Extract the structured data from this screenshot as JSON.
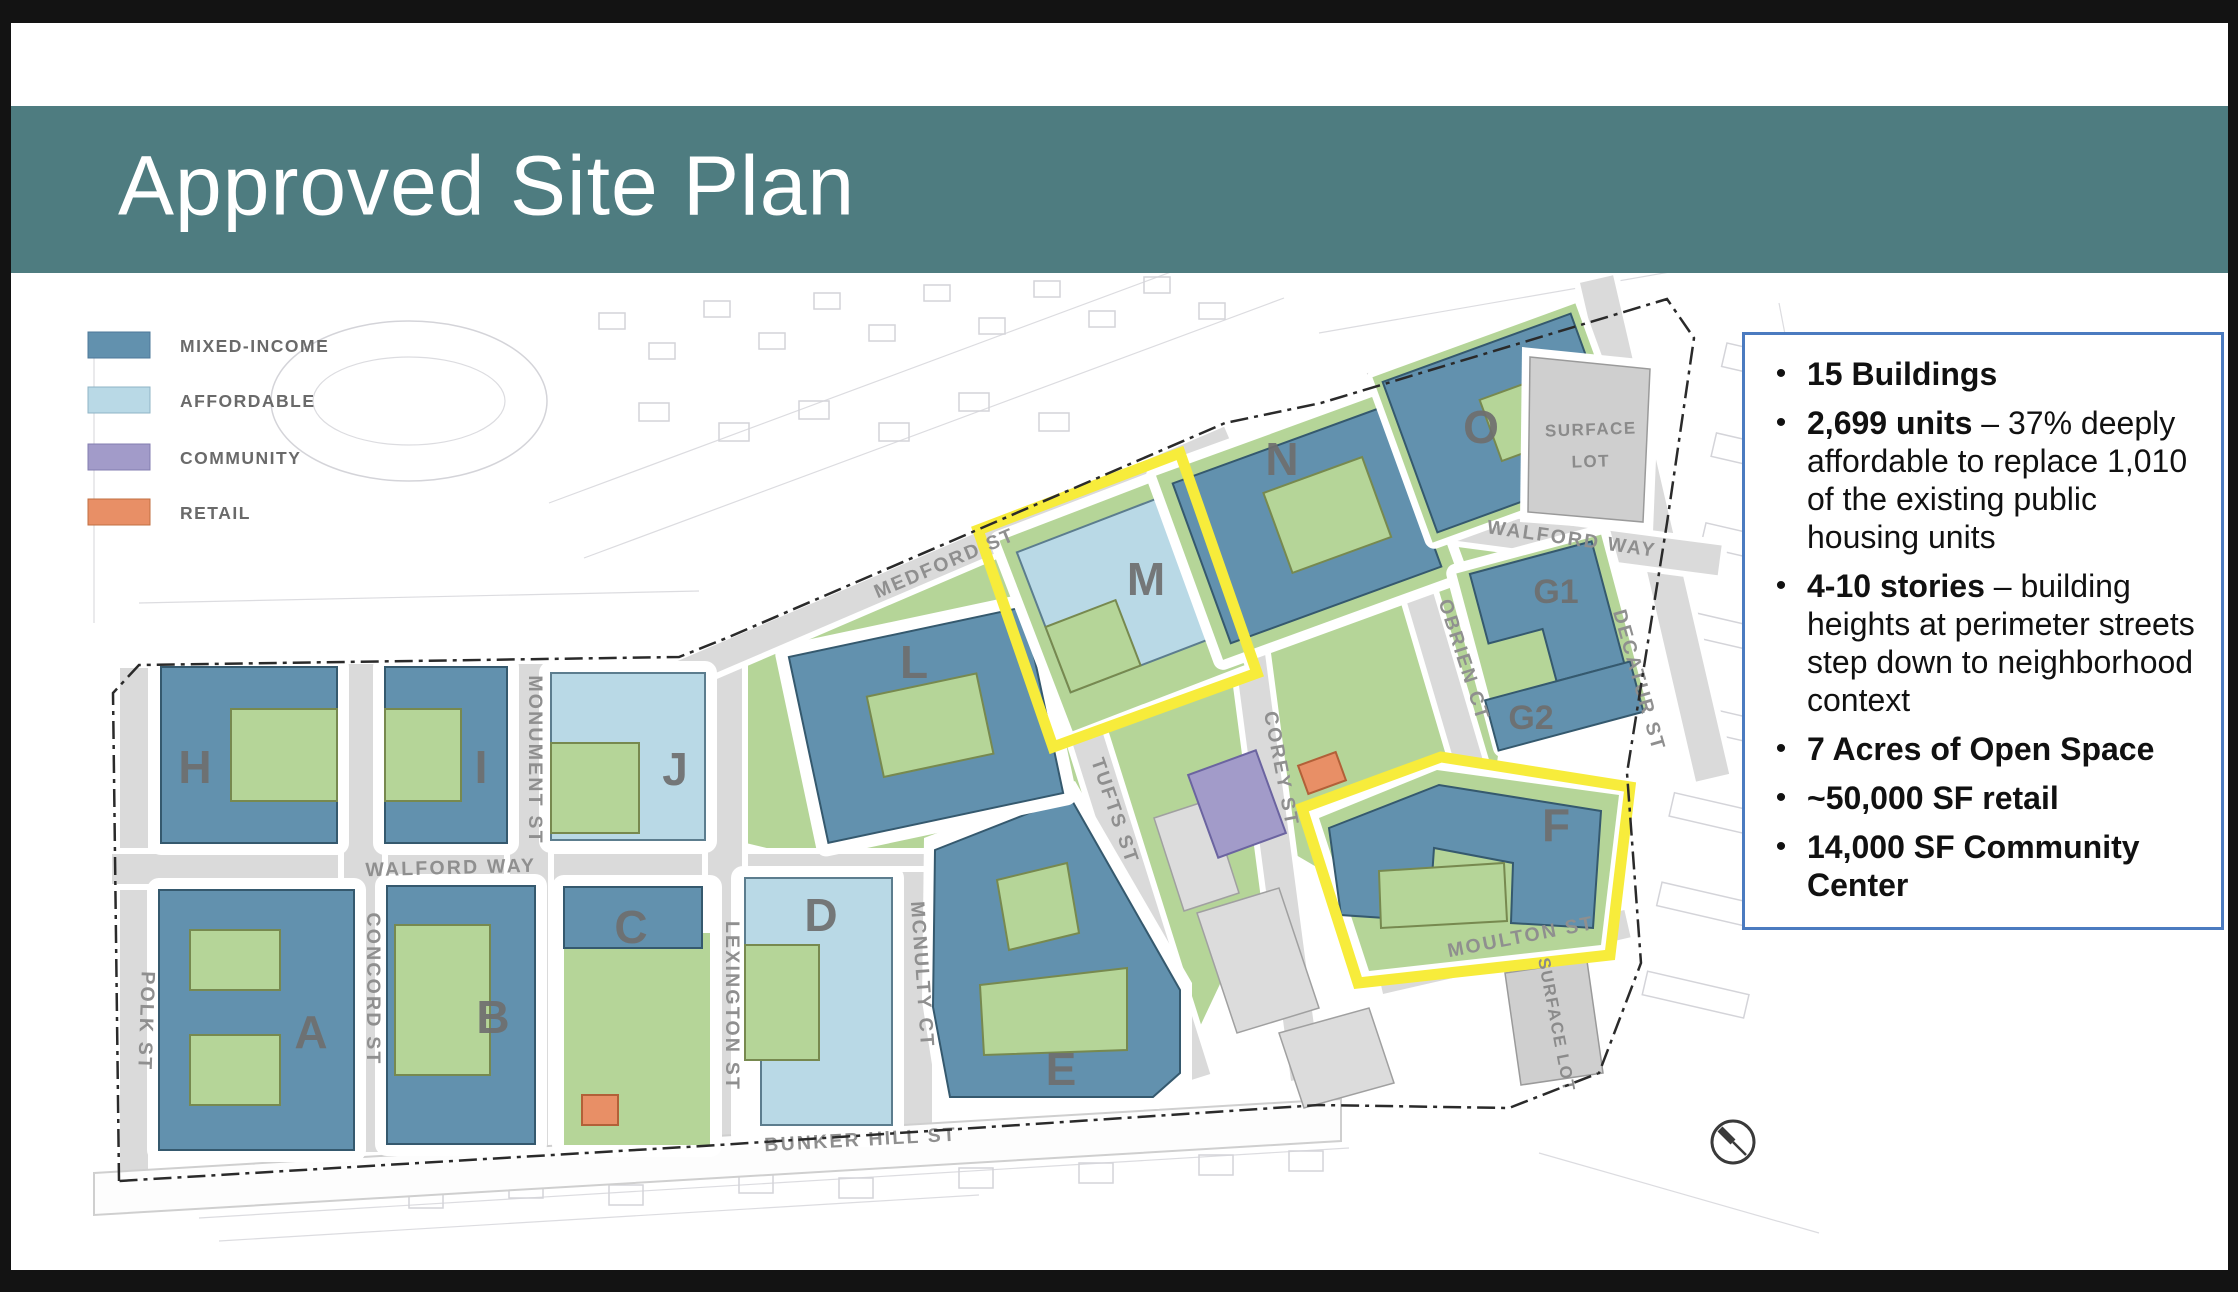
{
  "header": {
    "title": "Approved Site Plan"
  },
  "legend": {
    "items": [
      {
        "label": "MIXED-INCOME",
        "color": "#6291ae"
      },
      {
        "label": "AFFORDABLE",
        "color": "#b9d9e6"
      },
      {
        "label": "COMMUNITY",
        "color": "#a29bc9"
      },
      {
        "label": "RETAIL",
        "color": "#e88f66"
      }
    ]
  },
  "facts": {
    "items": [
      {
        "lead": "15 Buildings",
        "rest": ""
      },
      {
        "lead": "2,699 units",
        "rest": " – 37% deeply affordable to replace 1,010 of the existing public housing units"
      },
      {
        "lead": "4-10 stories",
        "rest": " – building heights at perimeter streets step down to neighborhood context"
      },
      {
        "lead": "7 Acres of Open Space",
        "rest": ""
      },
      {
        "lead": "~50,000 SF retail",
        "rest": ""
      },
      {
        "lead": "14,000 SF Community Center",
        "rest": ""
      }
    ]
  },
  "map": {
    "buildings": {
      "a": "A",
      "b": "B",
      "c": "C",
      "d": "D",
      "e": "E",
      "f": "F",
      "g1": "G1",
      "g2": "G2",
      "h": "H",
      "i": "I",
      "j": "J",
      "l": "L",
      "m": "M",
      "n": "N",
      "o": "O"
    },
    "streets": {
      "medford": "MEDFORD ST",
      "monument": "MONUMENT ST",
      "concord": "CONCORD ST",
      "polk": "POLK ST",
      "lexington": "LEXINGTON ST",
      "mcnulty": "MCNULTY CT",
      "walford_left": "WALFORD WAY",
      "walford_right": "WALFORD WAY",
      "tufts": "TUFTS ST",
      "corey": "COREY ST",
      "obrien": "OBRIEN CT",
      "decatur": "DECATUR ST",
      "moulton": "MOULTON ST",
      "bunker_hill": "BUNKER HILL ST"
    },
    "labels": {
      "surface_lot_line1": "SURFACE",
      "surface_lot_line2": "LOT",
      "surface_lot_side": "SURFACE LOT"
    },
    "colors": {
      "teal_header": "#4e7c80",
      "open_space_green": "#b5d598",
      "street_gray": "#dadada",
      "highlight_yellow": "#f7ec3b",
      "fact_box_border": "#4b7bc0"
    }
  }
}
